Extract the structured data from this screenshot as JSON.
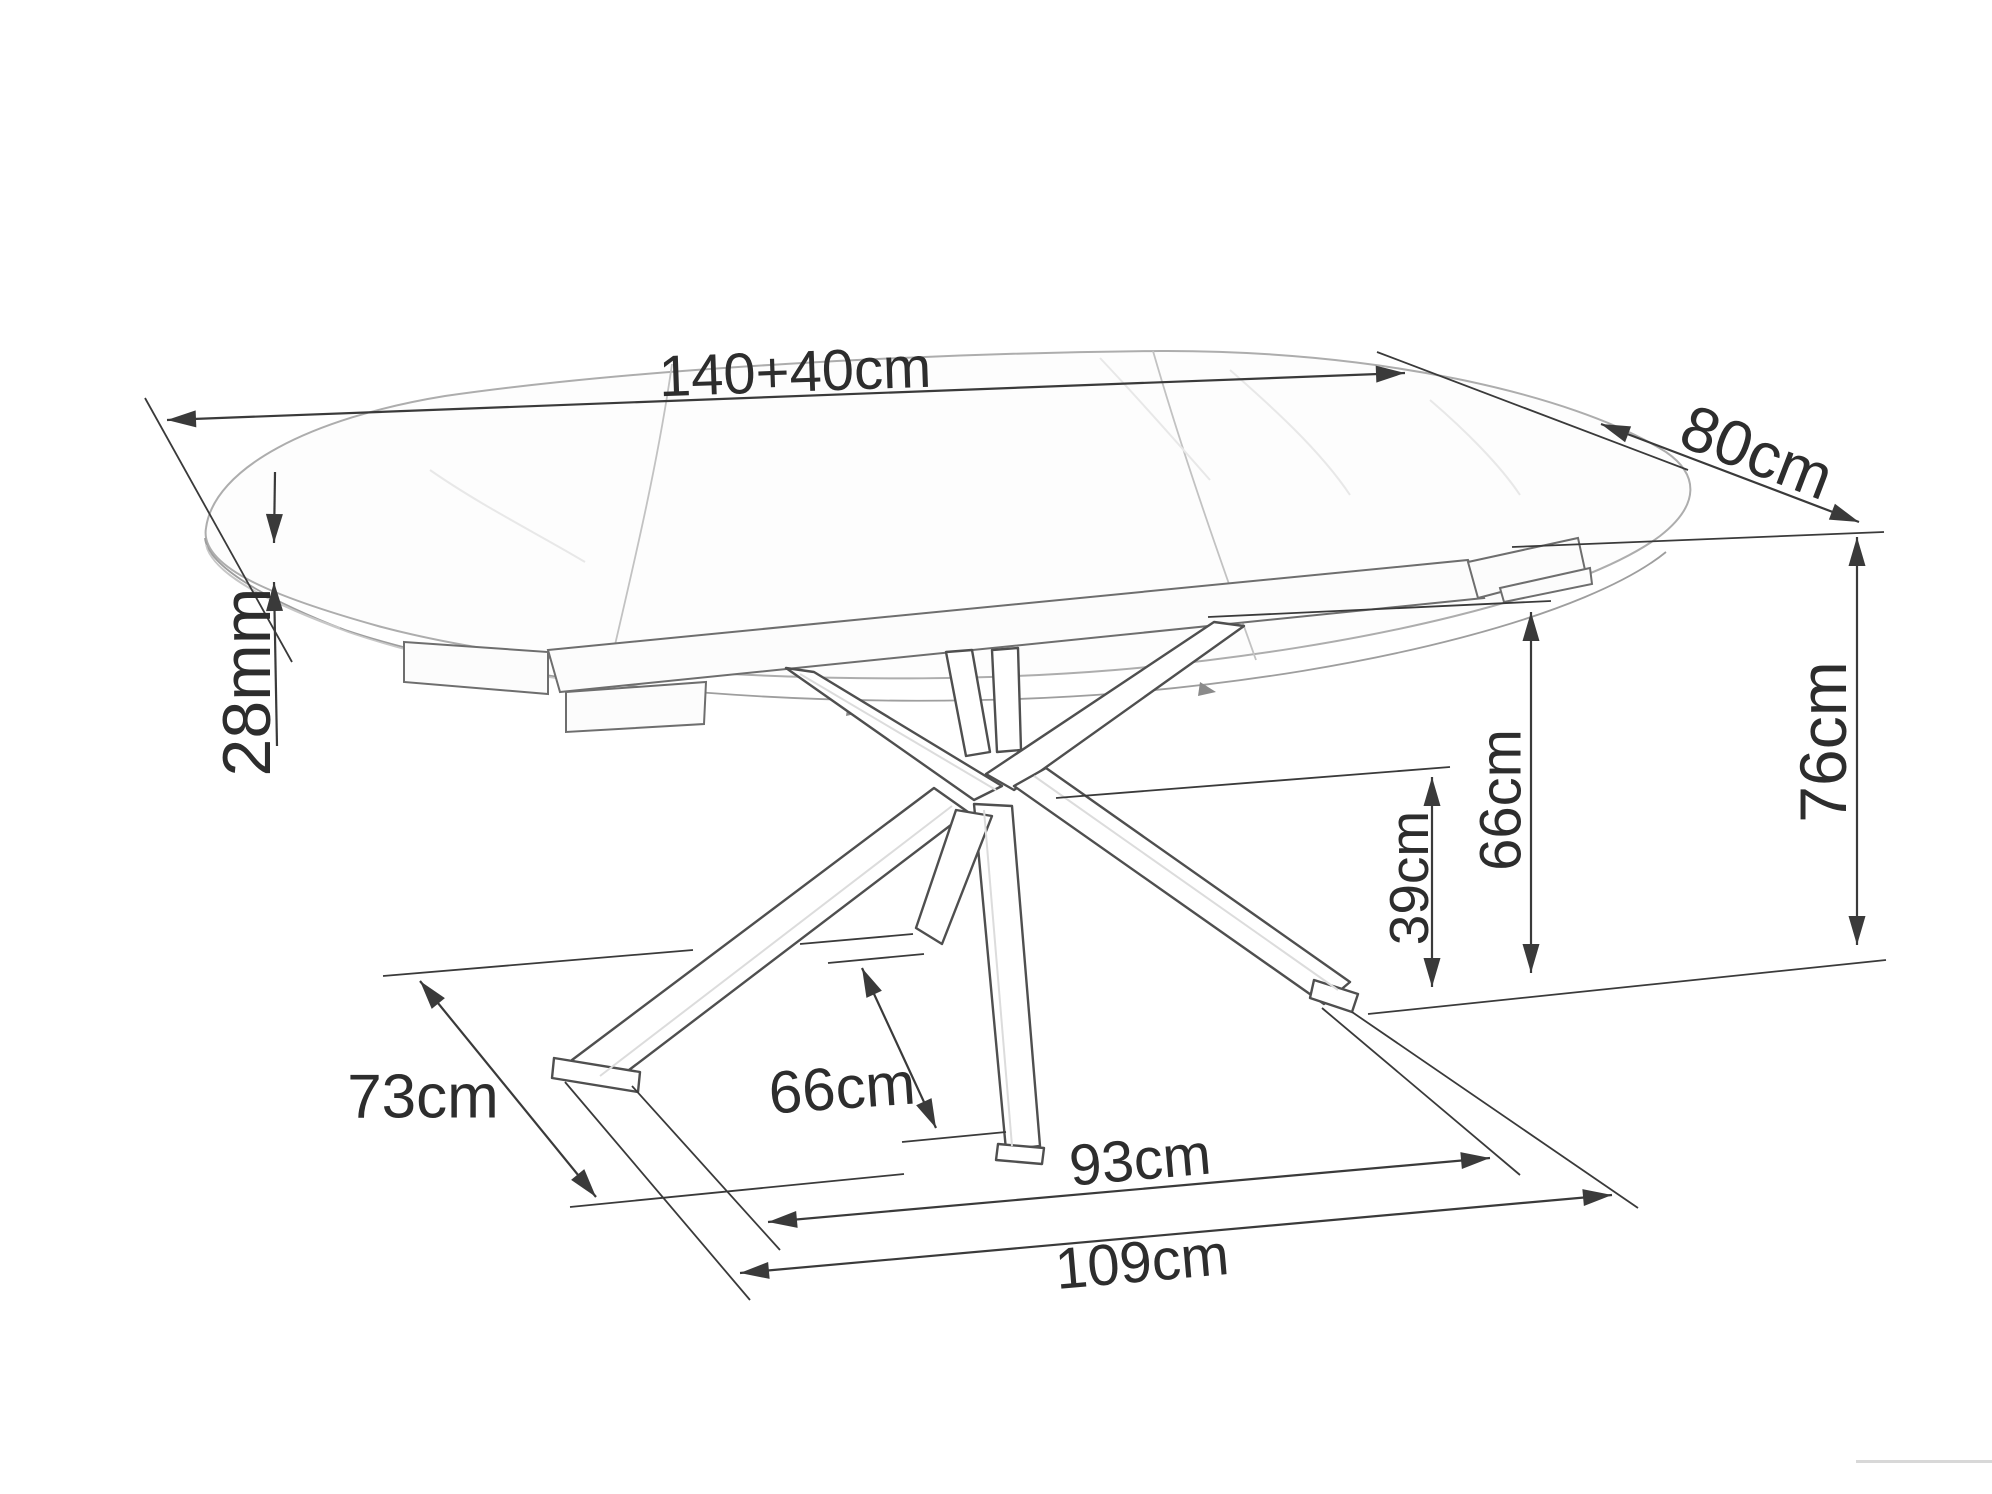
{
  "meta": {
    "drawing_type": "furniture dimension diagram",
    "subject": "extendable oval dining table with spider cross base",
    "background_color": "#ffffff",
    "line_color": "#3a3a3a",
    "text_color": "#2d2d2d"
  },
  "dimensions": {
    "length": {
      "label": "140+40cm"
    },
    "width": {
      "label": "80cm"
    },
    "top_thickness": {
      "label": "28mm"
    },
    "height": {
      "label": "76cm"
    },
    "apron_clearance": {
      "label": "66cm"
    },
    "base_center_height": {
      "label": "39cm"
    },
    "leg_strut_span": {
      "label": "66cm"
    },
    "base_span_inner": {
      "label": "93cm"
    },
    "base_span_outer": {
      "label": "109cm"
    },
    "base_depth": {
      "label": "73cm"
    }
  }
}
